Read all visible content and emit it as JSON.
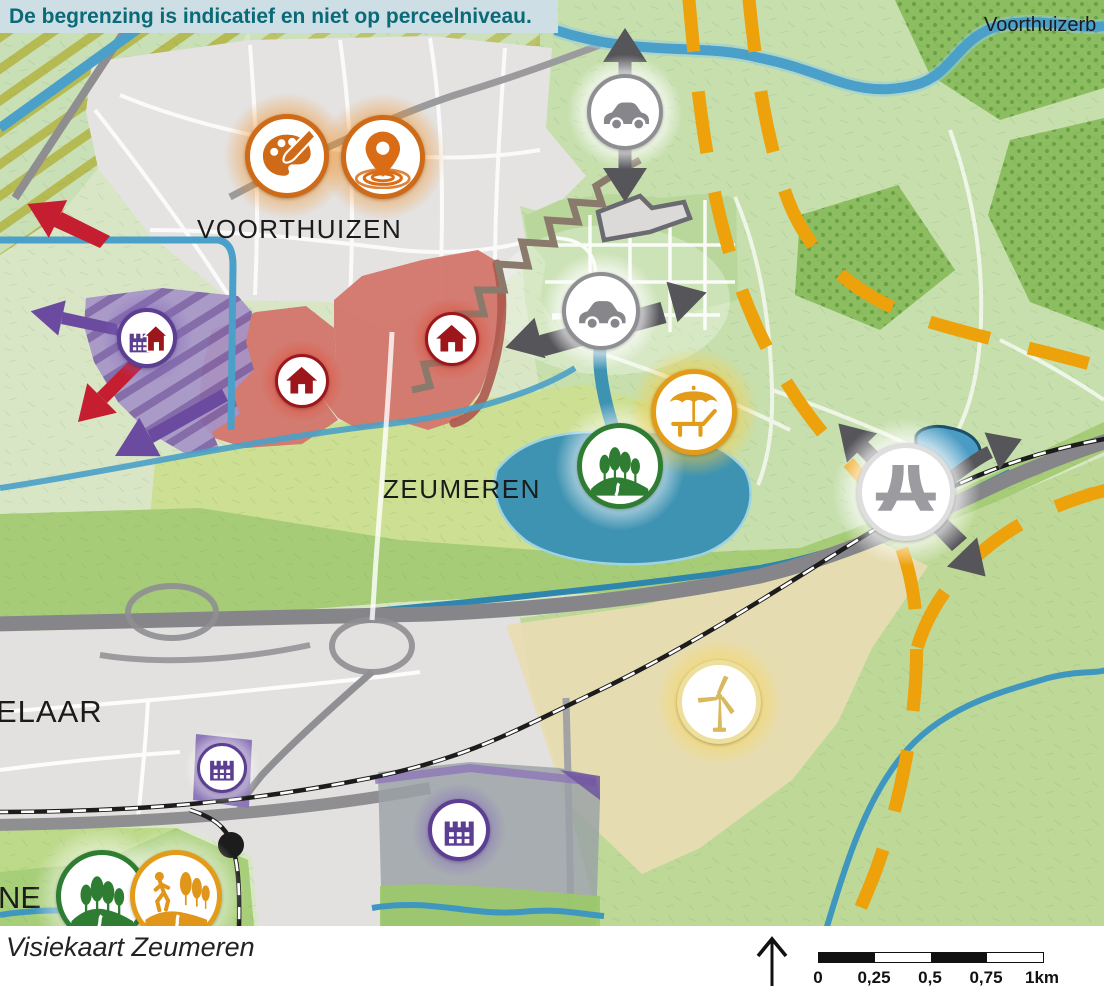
{
  "banner": {
    "text": "De begrenzing is indicatief en niet op perceelniveau."
  },
  "map": {
    "labels": [
      {
        "id": "voorthuizen",
        "text": "VOORTHUIZEN",
        "x": 197,
        "y": 214,
        "size": 26,
        "spacing": 1.5
      },
      {
        "id": "zeumeren",
        "text": "ZEUMEREN",
        "x": 383,
        "y": 474,
        "size": 26,
        "spacing": 1.5
      },
      {
        "id": "elaar",
        "text": "ELAAR",
        "x": -4,
        "y": 694,
        "size": 31,
        "spacing": 1
      },
      {
        "id": "ne",
        "text": "NE",
        "x": -2,
        "y": 880,
        "size": 31,
        "spacing": 0
      },
      {
        "id": "voorthuizerbos",
        "text": "Voorthuizerb",
        "x": 984,
        "y": 14,
        "size": 20,
        "spacing": 0
      }
    ],
    "icons": [
      {
        "name": "palette-icon",
        "type": "palette",
        "x": 287,
        "y": 156,
        "d": 84,
        "ring": "#cf6a18",
        "color": "#cf6a18",
        "glow": "rgba(242,140,30,.55)"
      },
      {
        "name": "swim-location-icon",
        "type": "pin",
        "x": 383,
        "y": 157,
        "d": 84,
        "ring": "#cf6a18",
        "color": "#d96c15",
        "glow": "rgba(242,140,30,.55)"
      },
      {
        "name": "industry-housing-icon",
        "type": "factoryhouse",
        "x": 147,
        "y": 338,
        "d": 60,
        "ring": "#5c3e92",
        "color": "#5c3e92",
        "glow": "rgba(130,100,190,.45)"
      },
      {
        "name": "housing-icon-west",
        "type": "house",
        "x": 302,
        "y": 381,
        "d": 54,
        "ring": "#9c161c",
        "color": "#9c161c",
        "glow": "rgba(225,70,50,.5)"
      },
      {
        "name": "housing-icon-east",
        "type": "house",
        "x": 452,
        "y": 339,
        "d": 54,
        "ring": "#9c161c",
        "color": "#9c161c",
        "glow": "rgba(225,70,50,.5)"
      },
      {
        "name": "car-icon-north",
        "type": "car",
        "x": 625,
        "y": 112,
        "d": 76,
        "ring": "#8f8f93",
        "color": "#87878b",
        "glow": "rgba(255,255,255,.95)"
      },
      {
        "name": "car-icon-central",
        "type": "car",
        "x": 601,
        "y": 311,
        "d": 78,
        "ring": "#8f8f93",
        "color": "#87878b",
        "glow": "rgba(255,255,255,.95)"
      },
      {
        "name": "nature-icon-central",
        "type": "trees",
        "x": 620,
        "y": 466,
        "d": 86,
        "ring": "#2e7d32",
        "color": "#2e7d32",
        "glow": "rgba(255,255,255,.7)"
      },
      {
        "name": "recreation-icon",
        "type": "lounger",
        "x": 694,
        "y": 412,
        "d": 86,
        "ring": "#e39c1a",
        "color": "#e39c1a",
        "glow": "rgba(248,205,70,.7)"
      },
      {
        "name": "motorway-icon",
        "type": "motorway",
        "x": 906,
        "y": 492,
        "d": 98,
        "ring": "#dededf",
        "color": "#9b9ba0",
        "glow": "rgba(255,255,255,.95)"
      },
      {
        "name": "wind-turbine-icon",
        "type": "turbine",
        "x": 719,
        "y": 702,
        "d": 84,
        "ring": "#eedf9c",
        "color": "#d9b95e",
        "glow": "rgba(247,216,100,.75)"
      },
      {
        "name": "industry-icon-west",
        "type": "factory",
        "x": 222,
        "y": 768,
        "d": 50,
        "ring": "#5c3e92",
        "color": "#5c3e92",
        "glow": "rgba(255,255,255,.6)"
      },
      {
        "name": "industry-icon-south",
        "type": "factory",
        "x": 459,
        "y": 830,
        "d": 62,
        "ring": "#5c3e92",
        "color": "#5c3e92",
        "glow": "rgba(130,100,190,.5)"
      },
      {
        "name": "nature-icon-southwest",
        "type": "trees",
        "x": 102,
        "y": 896,
        "d": 92,
        "ring": "#2e7d32",
        "color": "#2e7d32",
        "glow": "rgba(255,255,255,.6)"
      },
      {
        "name": "walking-icon-southwest",
        "type": "walker",
        "x": 176,
        "y": 896,
        "d": 92,
        "ring": "#e39c1a",
        "color": "#e0951b",
        "glow": "rgba(255,255,255,.6)"
      }
    ]
  },
  "footer": {
    "caption": "Visiekaart Zeumeren",
    "scale_ticks": [
      "0",
      "0,25",
      "0,5",
      "0,75",
      "1km"
    ]
  },
  "colors": {
    "banner_bg": "#cddee4",
    "banner_text": "#0a6a78",
    "orange_dashed": "#eda10b",
    "dark_arrow": "#55555a",
    "red_arrow": "#c41e30",
    "purple_arrow": "#6b4b9f",
    "lake": "#3f93b2",
    "urban": "#e4e3e2",
    "residential_red": "#d3756b",
    "industry_purple": "#8d77b8",
    "energy_beige": "#e8dcb2",
    "highway_gray": "#86868a"
  }
}
